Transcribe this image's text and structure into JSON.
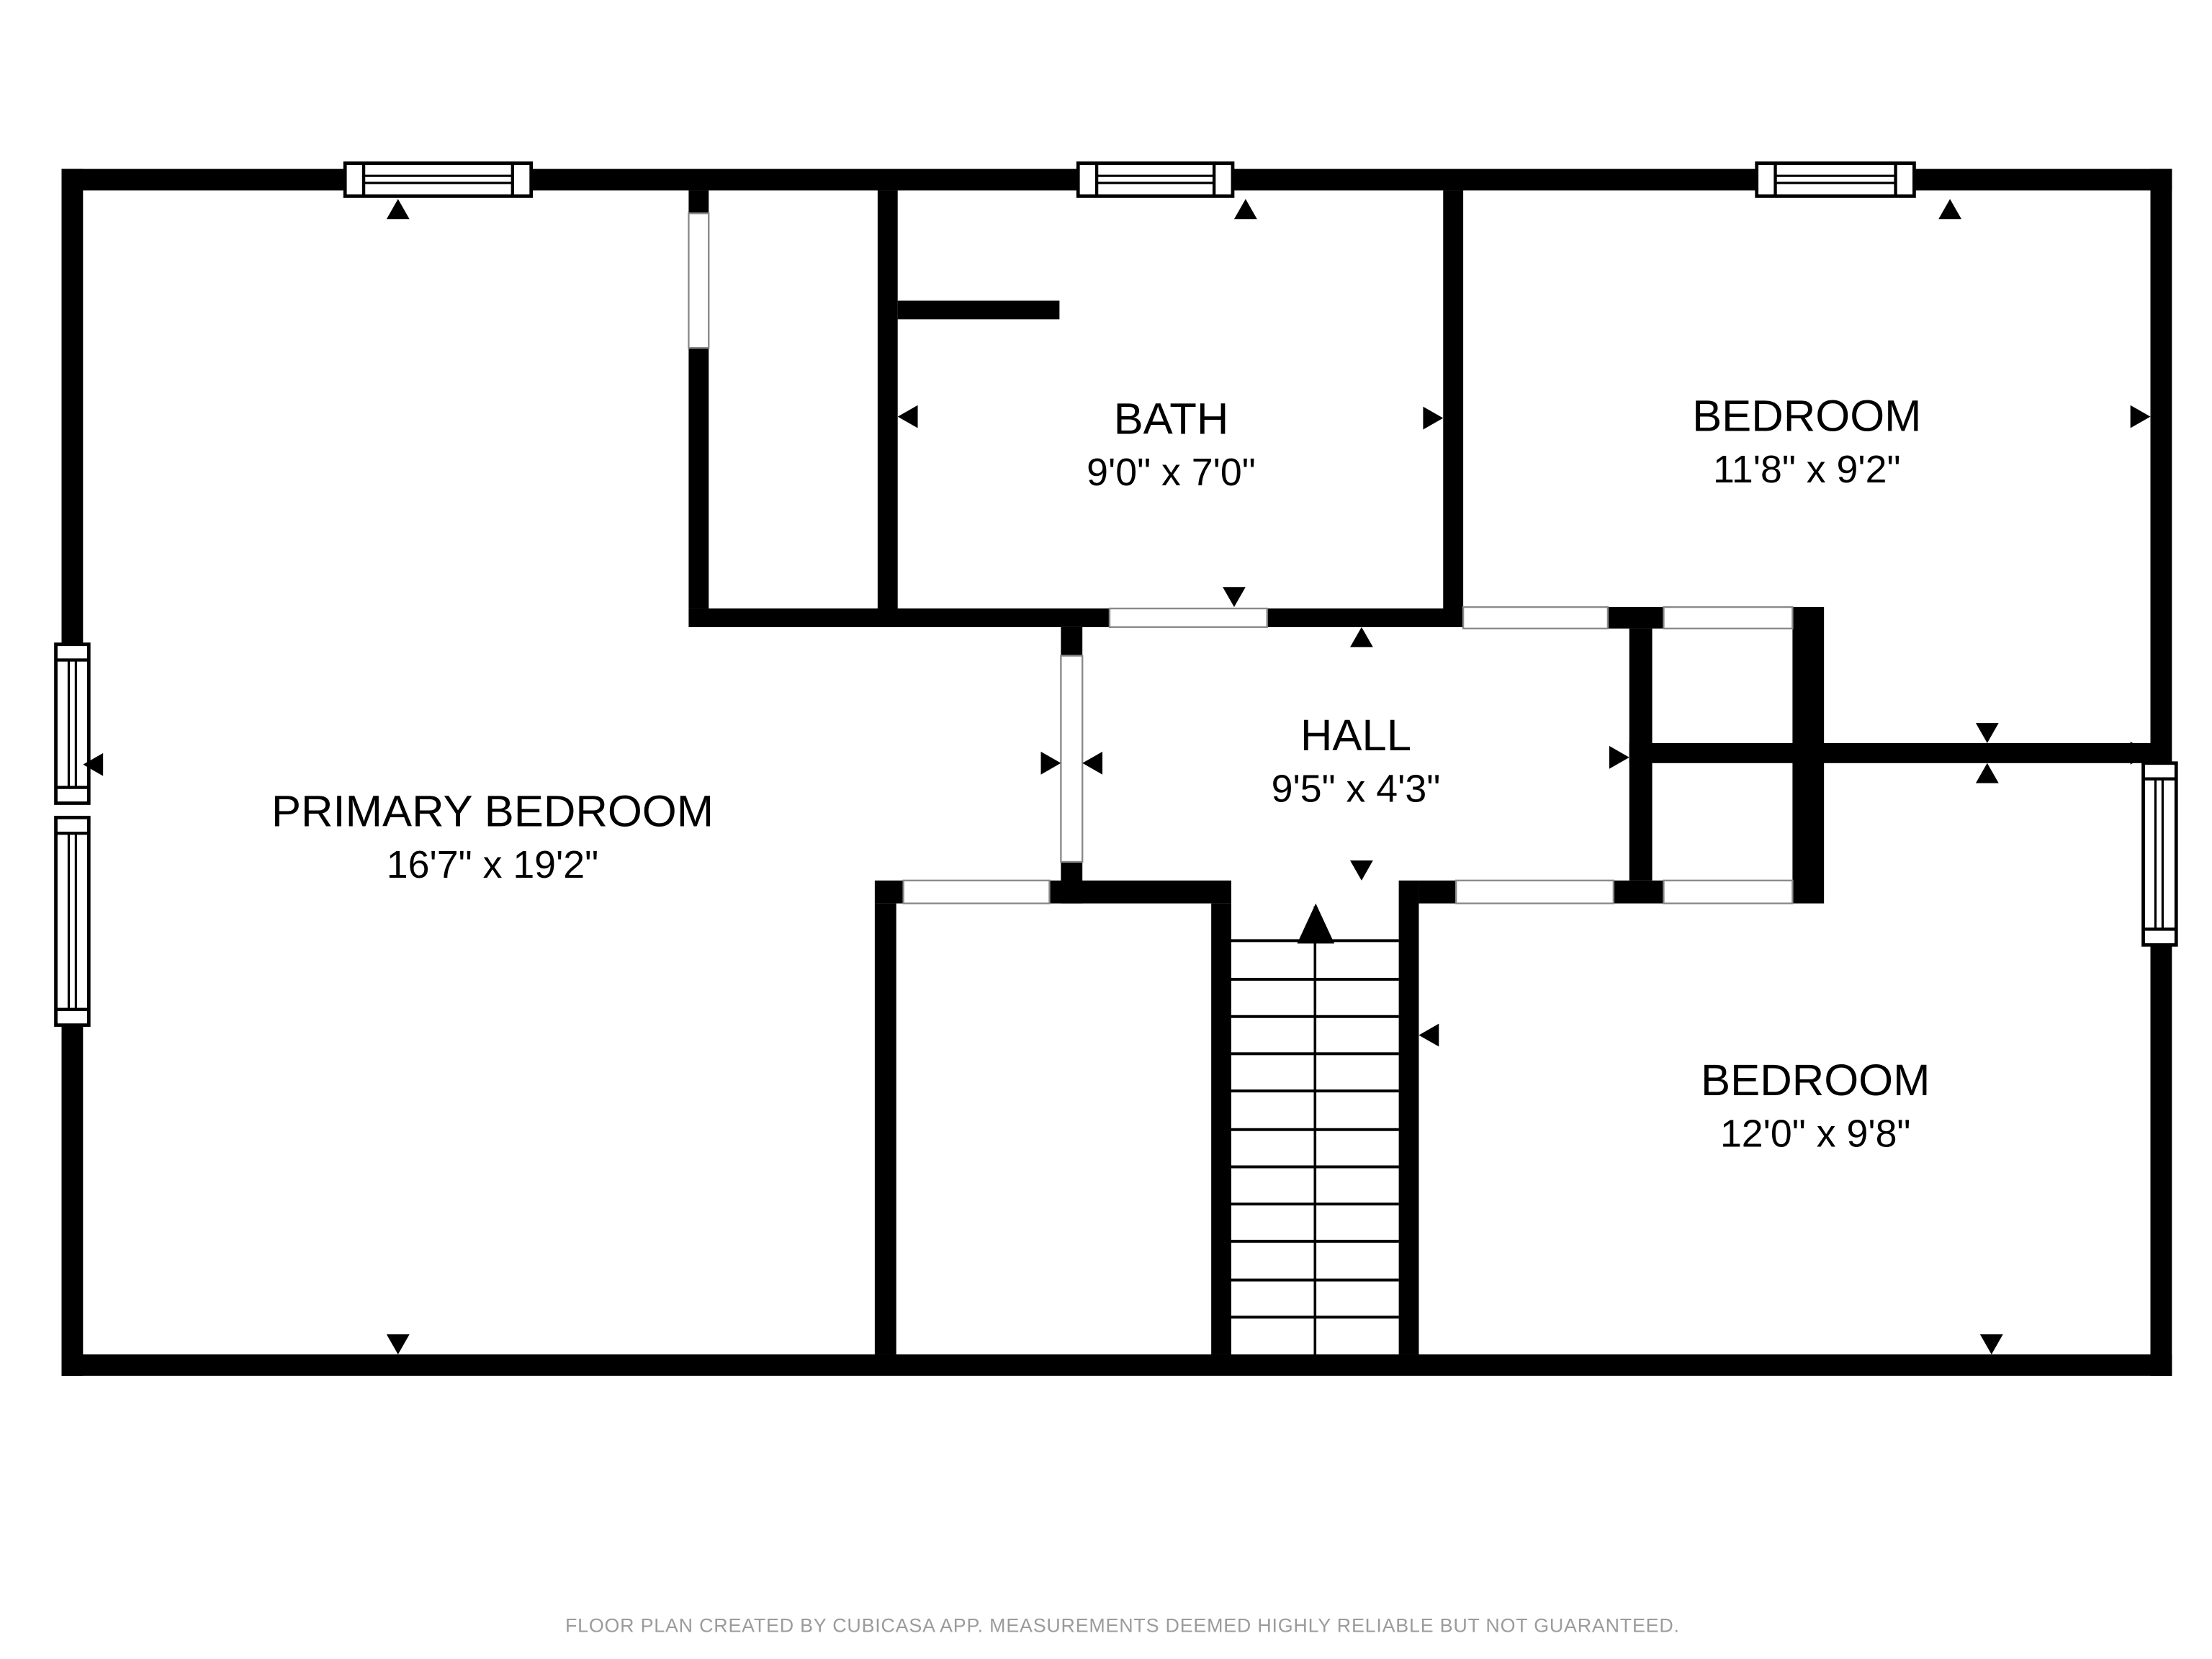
{
  "rooms": {
    "primary_bedroom": {
      "name": "PRIMARY BEDROOM",
      "dimensions": "16'7\" x 19'2\""
    },
    "bath": {
      "name": "BATH",
      "dimensions": "9'0\" x 7'0\""
    },
    "bedroom_top": {
      "name": "BEDROOM",
      "dimensions": "11'8\" x 9'2\""
    },
    "hall": {
      "name": "HALL",
      "dimensions": "9'5\" x 4'3\""
    },
    "bedroom_bottom": {
      "name": "BEDROOM",
      "dimensions": "12'0\" x 9'8\""
    }
  },
  "footer": {
    "text": "FLOOR PLAN CREATED BY CUBICASA APP. MEASUREMENTS DEEMED HIGHLY RELIABLE BUT NOT GUARANTEED."
  },
  "colors": {
    "wall": "#000000",
    "background": "#ffffff",
    "footer_text": "#9b9b9b"
  }
}
